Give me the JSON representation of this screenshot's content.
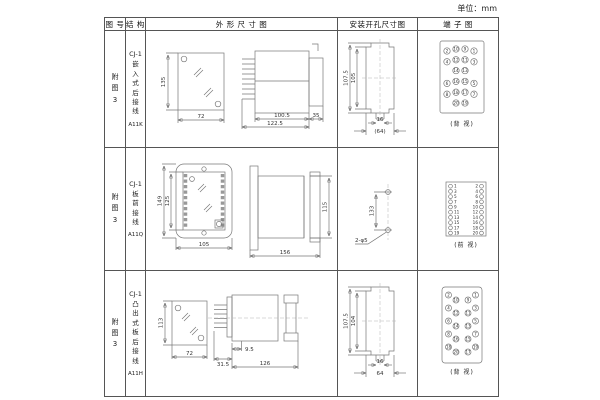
{
  "unit_label": "单位：mm",
  "headers": {
    "fig": "图 号",
    "structure": "结 构",
    "outline": "外 形 尺 寸 图",
    "install": "安装开孔尺寸图",
    "terminal": "端 子 图"
  },
  "rows": [
    {
      "fig": "附\n图\n3",
      "struct_top": "CJ-1",
      "struct_chars": "嵌\n入\n式\n后\n接\n线",
      "model": "A11K",
      "outline": {
        "h": "135",
        "w": "72",
        "body": "100.5",
        "total": "122.5",
        "rear": "35"
      },
      "install": {
        "outer_h": "107.5",
        "inner_h": "105",
        "slot_w": "16",
        "hole_w": "(64)"
      },
      "terminal": {
        "label": "(背 视)",
        "g": [
          [
            "2",
            "10",
            "9",
            "1"
          ],
          [
            "4",
            "12",
            "11",
            "3"
          ],
          [
            "14",
            "13"
          ],
          [
            "6",
            "16",
            "15",
            "5"
          ],
          [
            "8",
            "18",
            "17",
            "7"
          ],
          [
            "20",
            "19"
          ]
        ]
      }
    },
    {
      "fig": "附\n图\n3",
      "struct_top": "CJ-1",
      "struct_chars": "板\n前\n接\n线",
      "model": "A11Q",
      "outline": {
        "outer_h": "149",
        "inner_h": "125",
        "w": "105",
        "depth": "156",
        "side_h": "115"
      },
      "install": {
        "pitch": "133",
        "hole": "2-φ5"
      },
      "terminal": {
        "label": "(前 视)",
        "left": [
          "1",
          "3",
          "5",
          "7",
          "9",
          "11",
          "13",
          "15",
          "17",
          "19"
        ],
        "right": [
          "2",
          "4",
          "6",
          "8",
          "10",
          "12",
          "14",
          "16",
          "18",
          "20"
        ]
      }
    },
    {
      "fig": "附\n图\n3",
      "struct_top": "CJ-1",
      "struct_chars": "凸\n出\n式\n板\n后\n接\n线",
      "model": "A11H",
      "outline": {
        "h": "113",
        "w": "72",
        "pin": "31.5",
        "offset": "9.5",
        "depth": "126"
      },
      "install": {
        "outer_h": "107.5",
        "inner_h": "104",
        "slot_w": "16",
        "hole_w": "64"
      },
      "terminal": {
        "label": "(背 视)",
        "lo": [
          "2",
          "4",
          "6",
          "8",
          "18"
        ],
        "li": [
          "10",
          "12",
          "14",
          "16",
          "20"
        ],
        "ri": [
          "9",
          "11",
          "13",
          "15",
          "17"
        ],
        "ro": [
          "1",
          "3",
          "5",
          "7",
          "19"
        ]
      }
    }
  ]
}
